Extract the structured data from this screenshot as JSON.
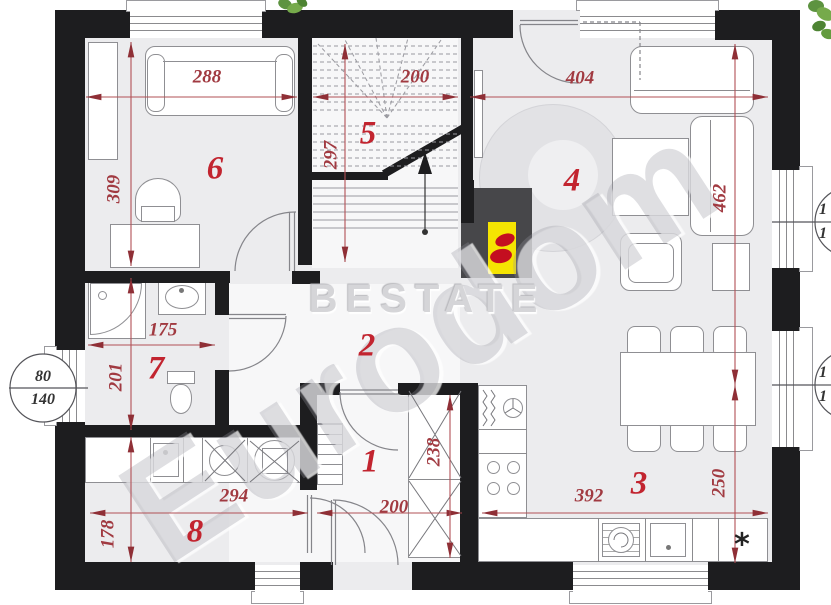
{
  "watermarks": {
    "center": "BESTATE",
    "diagonal": "Eurodom"
  },
  "rooms": {
    "r1": "1",
    "r2": "2",
    "r3": "3",
    "r4": "4",
    "r5": "5",
    "r6": "6",
    "r7": "7",
    "r8": "8"
  },
  "dims": {
    "d288": "288",
    "d200_stairs": "200",
    "d404": "404",
    "d309": "309",
    "d297": "297",
    "d462": "462",
    "d250": "250",
    "d175": "175",
    "d201": "201",
    "d178": "178",
    "d294": "294",
    "d200_hall": "200",
    "d238": "238",
    "d392": "392"
  },
  "window_labels": {
    "left": {
      "top": "80",
      "bottom": "140"
    },
    "right_upper": {
      "top": "1",
      "bottom": "1"
    },
    "right_lower": {
      "top": "1",
      "bottom": "1"
    }
  },
  "symbols": {
    "kitchen_star": "*"
  },
  "colors": {
    "wall": "#1d1d1f",
    "dimension_red": "#a13a41",
    "room_number_red": "#c2242f",
    "fireplace_yellow": "#f5e402",
    "flame_red": "#c40e20",
    "chimney_gray": "#47474a",
    "plant_green": "#5d9340"
  }
}
